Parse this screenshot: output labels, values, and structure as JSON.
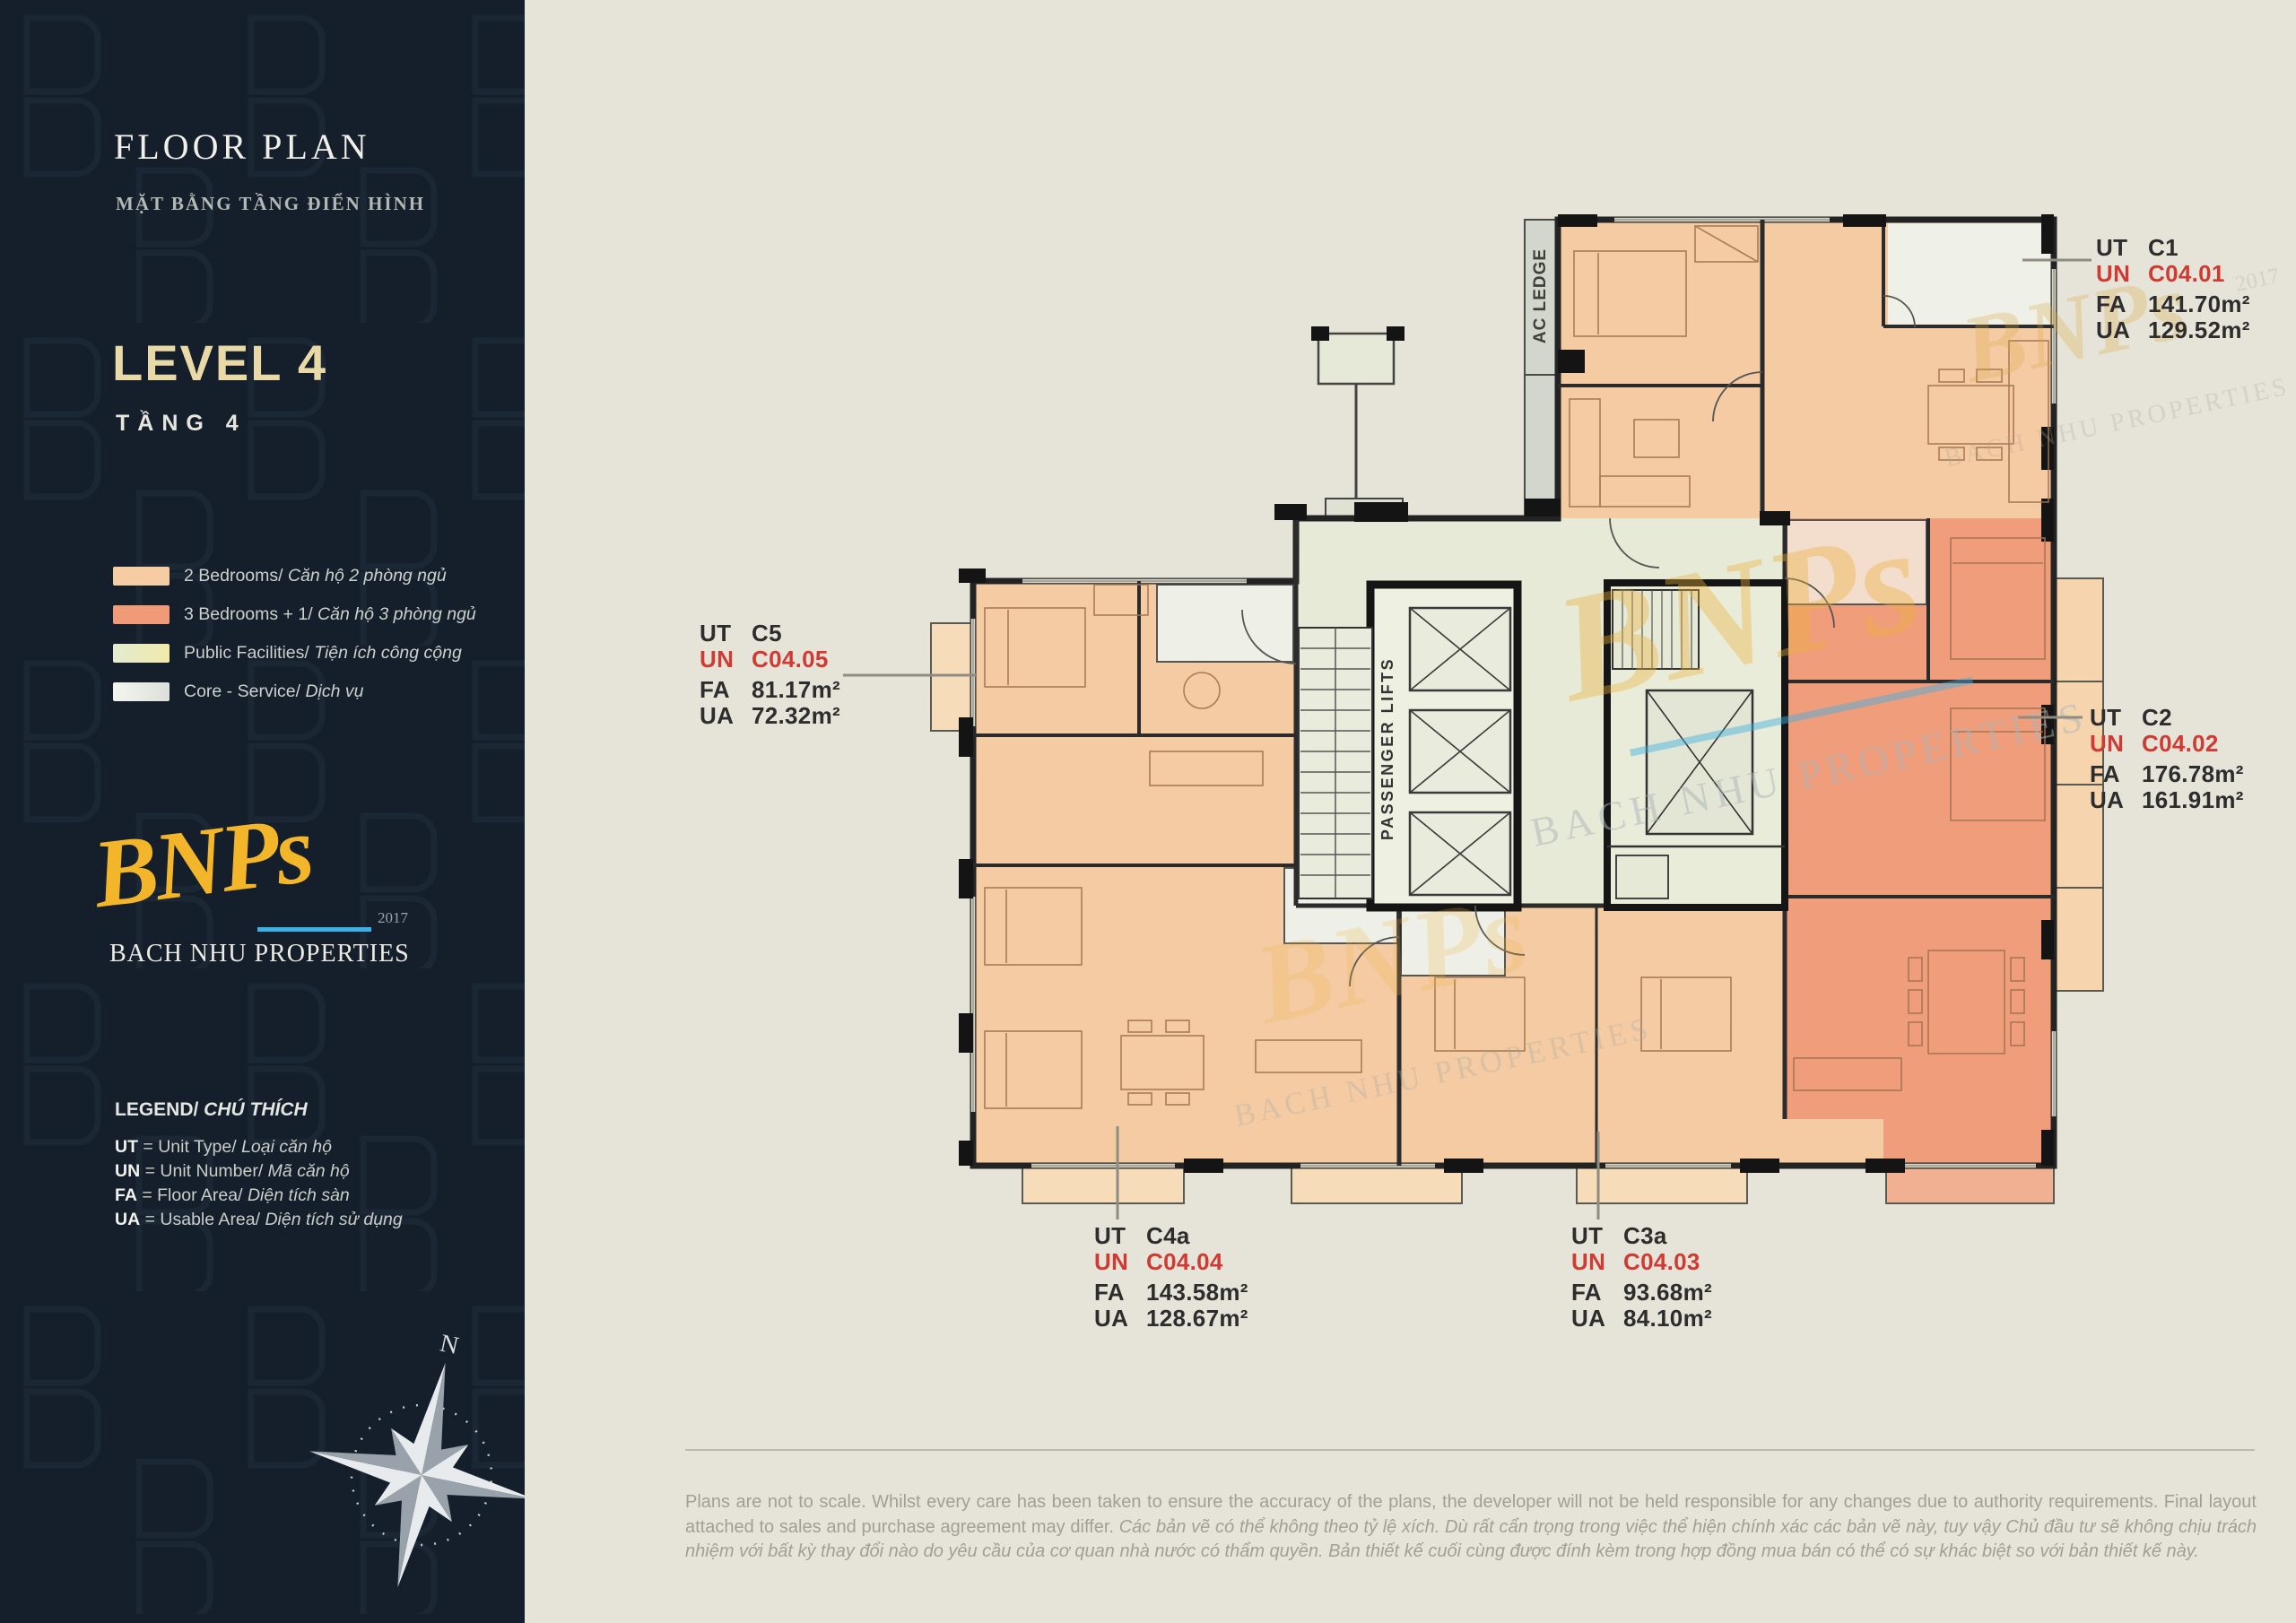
{
  "sidebar": {
    "title": "FLOOR PLAN",
    "subtitle": "MẶT BẰNG TẦNG ĐIỂN HÌNH",
    "level_en": "LEVEL 4",
    "level_vi": "TẦNG 4",
    "legend": [
      {
        "color": "#f6cda3",
        "en": "2 Bedrooms/",
        "vi": " Căn hộ 2 phòng ngủ"
      },
      {
        "color": "#f09a78",
        "en": "3 Bedrooms + 1/",
        "vi": " Căn hộ 3 phòng ngủ"
      },
      {
        "color": "#e9edd2",
        "en": "Public Facilities/",
        "vi": " Tiện ích công cộng"
      },
      {
        "color": "#f0f1ea",
        "en": "Core - Service/",
        "vi": " Dịch vụ"
      }
    ],
    "logo": {
      "script": "BNPs",
      "year": "2017",
      "name": "BACH NHU PROPERTIES"
    },
    "legend_title_en": "LEGEND/",
    "legend_title_vi": " CHÚ THÍCH",
    "abbr": [
      {
        "abbr": "UT",
        "en": " = Unit Type/",
        "vi": " Loại căn hộ"
      },
      {
        "abbr": "UN",
        "en": " = Unit Number/",
        "vi": " Mã căn hộ"
      },
      {
        "abbr": "FA",
        "en": " = Floor Area/",
        "vi": " Diện tích sàn"
      },
      {
        "abbr": "UA",
        "en": " = Usable Area/",
        "vi": " Diện tích sử dụng"
      }
    ],
    "compass_n": "N"
  },
  "plan": {
    "ac_ledge": "AC LEDGE",
    "passenger_lifts": "PASSENGER LIFTS",
    "watermark": {
      "script": "BNPs",
      "name": "BACH NHU PROPERTIES",
      "year": "2017"
    }
  },
  "units": [
    {
      "ut": "UT",
      "type": "C1",
      "un": "UN",
      "number": "C04.01",
      "fa": "FA",
      "fa_value": "141.70m²",
      "ua": "UA",
      "ua_value": "129.52m²"
    },
    {
      "ut": "UT",
      "type": "C2",
      "un": "UN",
      "number": "C04.02",
      "fa": "FA",
      "fa_value": "176.78m²",
      "ua": "UA",
      "ua_value": "161.91m²"
    },
    {
      "ut": "UT",
      "type": "C5",
      "un": "UN",
      "number": "C04.05",
      "fa": "FA",
      "fa_value": "81.17m²",
      "ua": "UA",
      "ua_value": "72.32m²"
    },
    {
      "ut": "UT",
      "type": "C4a",
      "un": "UN",
      "number": "C04.04",
      "fa": "FA",
      "fa_value": "143.58m²",
      "ua": "UA",
      "ua_value": "128.67m²"
    },
    {
      "ut": "UT",
      "type": "C3a",
      "un": "UN",
      "number": "C04.03",
      "fa": "FA",
      "fa_value": "93.68m²",
      "ua": "UA",
      "ua_value": "84.10m²"
    }
  ],
  "disclaimer": {
    "en": "Plans are not to scale. Whilst every care has been taken to ensure the accuracy of the plans, the developer will not be held responsible for any changes due to authority requirements. Final layout attached to sales and purchase agreement may differ.",
    "vi": " Các bản vẽ có thể không theo tỷ lệ xích. Dù rất cẩn trọng trong việc thể hiện chính xác các bản vẽ này, tuy vậy Chủ đầu tư sẽ không chịu trách nhiệm với bất kỳ thay đổi nào do yêu cầu của cơ quan nhà nước có thẩm quyền. Bản thiết kế cuối cùng được đính kèm trong hợp đồng mua bán có thể có sự khác biệt so với bản thiết kế này."
  }
}
